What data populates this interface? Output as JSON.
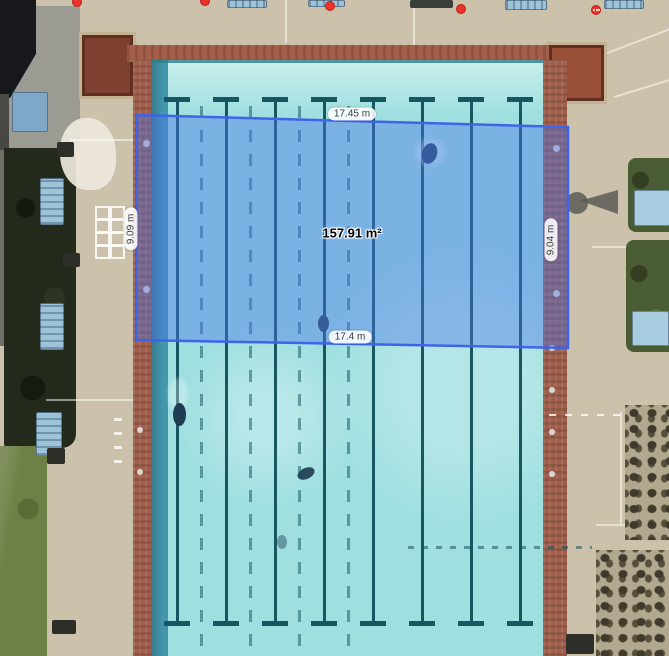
{
  "view": {
    "description": "Aerial satellite view of an outdoor lap swimming pool with an area measurement overlay",
    "width_px": 669,
    "height_px": 656
  },
  "measurement": {
    "labels": {
      "top": "17.45 m",
      "bottom": "17.4 m",
      "left": "9.09 m",
      "right": "9.04 m",
      "area": "157.91 m²"
    },
    "label_positions": {
      "top": [
        352,
        114
      ],
      "bottom": [
        350,
        337
      ],
      "left": [
        131,
        229
      ],
      "right": [
        551,
        240
      ],
      "area": [
        352,
        233
      ]
    },
    "polygon_points": "137,115 568,127 568,348 136,340",
    "fill_color": "#4a74ea",
    "fill_opacity": 0.42,
    "stroke_color": "#3e64e8",
    "stroke_width": 2.5
  },
  "markers": {
    "color": "#e8342a",
    "items": [
      {
        "x": 77,
        "y": 2,
        "type": "dot",
        "name": "red-map-marker"
      },
      {
        "x": 205,
        "y": 1,
        "type": "dot",
        "name": "red-map-marker"
      },
      {
        "x": 330,
        "y": 6,
        "type": "dot",
        "name": "red-map-marker"
      },
      {
        "x": 461,
        "y": 9,
        "type": "dot",
        "name": "red-map-marker"
      },
      {
        "x": 596,
        "y": 10,
        "type": "dotted-badge",
        "name": "red-map-marker-dotted"
      }
    ]
  },
  "scene": {
    "colors": {
      "deck_tan": "#ccc2ab",
      "deck_gray": "#9b9b94",
      "building_dark": "#17181c",
      "hedge_dark": "#232a1c",
      "grass_green": "#6e8045",
      "water_turquoise": "#9fdfe0",
      "water_pale": "#c9efec",
      "gutter_teal": "#4397ad",
      "lane_rope_teal": "#175761",
      "brick_red": "#a2604c",
      "wood_platform_brown": "#8c4a38",
      "bench_blue": "#9cc3d8"
    },
    "pool": {
      "lane_rope_xs": [
        177,
        226,
        275,
        324,
        373,
        422,
        471,
        520
      ],
      "dashed_line_xs": [
        201,
        250,
        299,
        348
      ],
      "rope_top_y": 99,
      "rope_bottom_y": 626,
      "t_bar_half_width": 13
    },
    "wall_dots": [
      {
        "x": 146,
        "y": 143
      },
      {
        "x": 146,
        "y": 289
      },
      {
        "x": 556,
        "y": 148
      },
      {
        "x": 556,
        "y": 293
      }
    ],
    "deck_dash_column": [
      {
        "x": 114,
        "y": 418
      },
      {
        "x": 114,
        "y": 432
      },
      {
        "x": 114,
        "y": 446
      },
      {
        "x": 114,
        "y": 460
      }
    ],
    "edge_anchor_dots": [
      {
        "x": 552,
        "y": 348
      },
      {
        "x": 552,
        "y": 390
      },
      {
        "x": 552,
        "y": 432
      },
      {
        "x": 552,
        "y": 474
      },
      {
        "x": 140,
        "y": 430
      },
      {
        "x": 140,
        "y": 472
      }
    ]
  }
}
